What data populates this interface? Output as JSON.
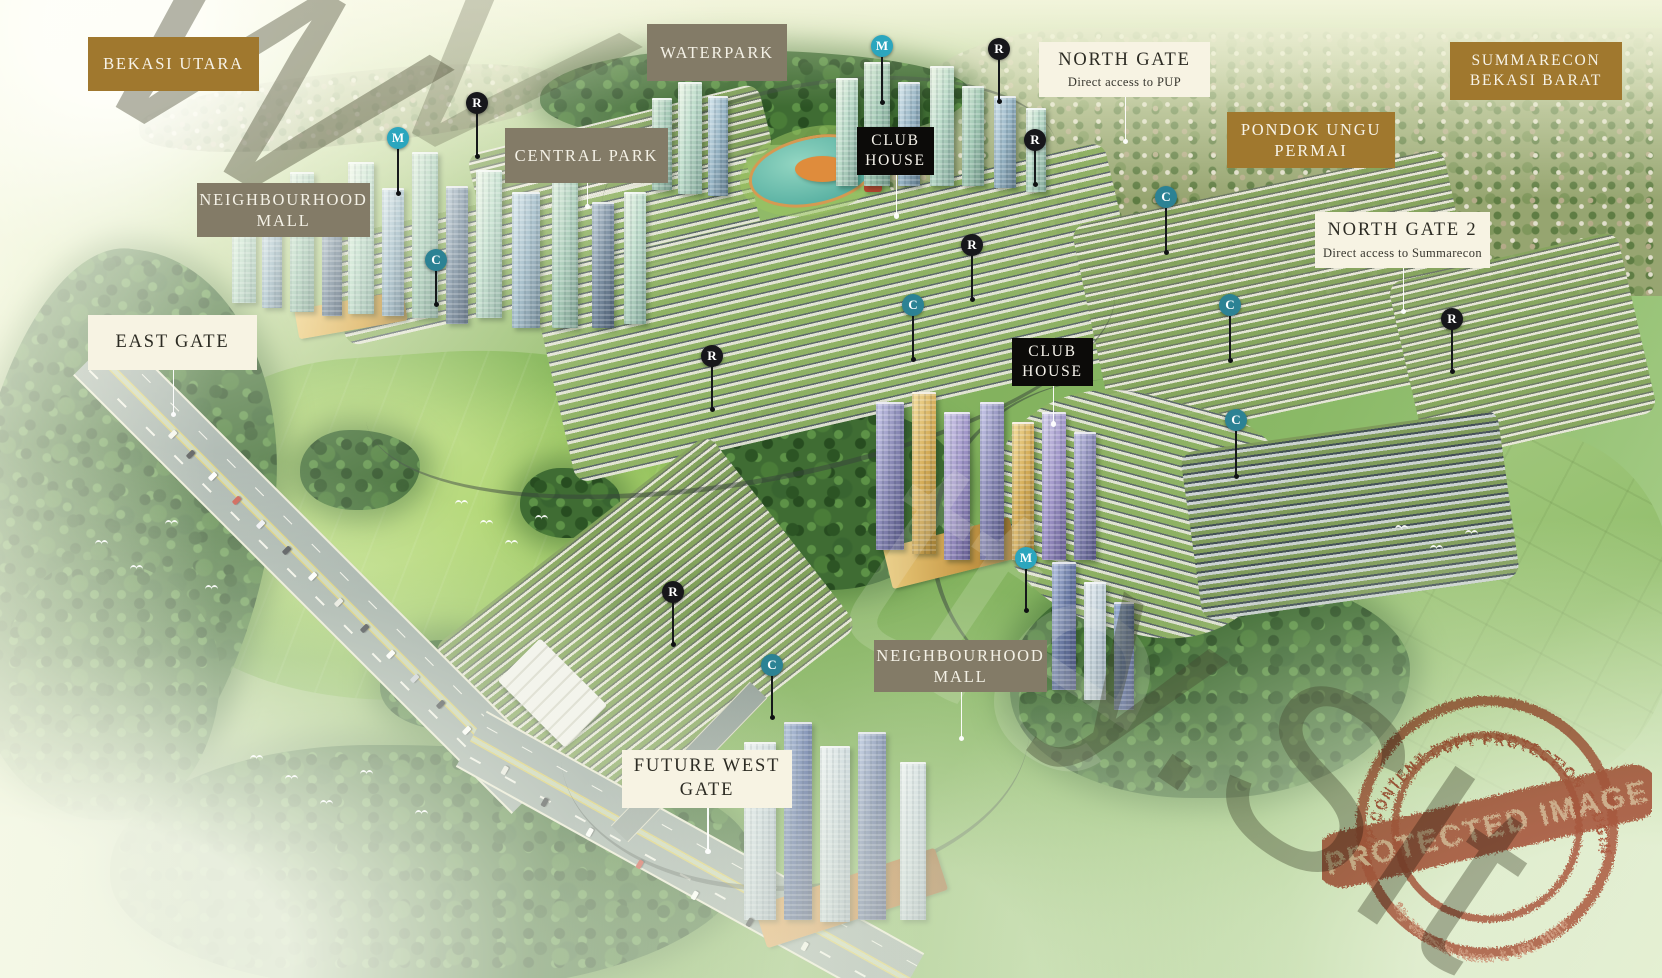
{
  "labels": [
    {
      "id": "bekasi-utara",
      "style": "gold",
      "text": "BEKASI UTARA"
    },
    {
      "id": "waterpark",
      "style": "gray",
      "text": "WATERPARK"
    },
    {
      "id": "north-gate",
      "style": "cream",
      "text": "NORTH GATE",
      "subtext": "Direct access to PUP"
    },
    {
      "id": "summarecon-bekasi-barat",
      "style": "gold",
      "text": "SUMMARECON BEKASI BARAT"
    },
    {
      "id": "central-park",
      "style": "gray",
      "text": "CENTRAL PARK"
    },
    {
      "id": "club-house-1",
      "style": "black",
      "text": "CLUB HOUSE"
    },
    {
      "id": "pondok-ungu-permai",
      "style": "gold",
      "text": "PONDOK UNGU PERMAI"
    },
    {
      "id": "neighbourhood-mall-1",
      "style": "gray",
      "text": "NEIGHBOURHOOD MALL"
    },
    {
      "id": "north-gate-2",
      "style": "cream",
      "text": "NORTH GATE 2",
      "subtext": "Direct access to Summarecon"
    },
    {
      "id": "east-gate",
      "style": "cream",
      "text": "EAST GATE"
    },
    {
      "id": "club-house-2",
      "style": "black",
      "text": "CLUB HOUSE"
    },
    {
      "id": "neighbourhood-mall-2",
      "style": "gray",
      "text": "NEIGHBOURHOOD MALL"
    },
    {
      "id": "future-west-gate",
      "style": "cream",
      "text": "FUTURE WEST GATE"
    }
  ],
  "markers": [
    {
      "letter": "R",
      "variant": "black"
    },
    {
      "letter": "M",
      "variant": "teal"
    },
    {
      "letter": "C",
      "variant": "teal"
    },
    {
      "letter": "M",
      "variant": "teal"
    },
    {
      "letter": "R",
      "variant": "black"
    },
    {
      "letter": "R",
      "variant": "black"
    },
    {
      "letter": "C",
      "variant": "teal"
    },
    {
      "letter": "R",
      "variant": "black"
    },
    {
      "letter": "C",
      "variant": "teal"
    },
    {
      "letter": "C",
      "variant": "teal"
    },
    {
      "letter": "R",
      "variant": "black"
    },
    {
      "letter": "R",
      "variant": "black"
    },
    {
      "letter": "C",
      "variant": "teal"
    },
    {
      "letter": "M",
      "variant": "teal"
    },
    {
      "letter": "R",
      "variant": "black"
    },
    {
      "letter": "C",
      "variant": "teal"
    }
  ],
  "stamp": {
    "arc_top": "WP CONTENT COPY PROTECTION PLUGIN",
    "banner": "PROTECTED IMAGE",
    "arc_bottom": "My Website Name & URL Here"
  },
  "watermark": {
    "nw": "W",
    "nw2": "V",
    "mid": "tte",
    "se": "y.SIt"
  },
  "colors": {
    "label_gold": "#a0782e",
    "label_gray": "#837b67",
    "label_cream": "#f7f3e3",
    "label_black": "#0c0b09",
    "marker_black": "#17171b",
    "marker_teal_m": "#2ba6be",
    "marker_teal_c": "#2c8294",
    "stamp_red": "#b5402c"
  }
}
